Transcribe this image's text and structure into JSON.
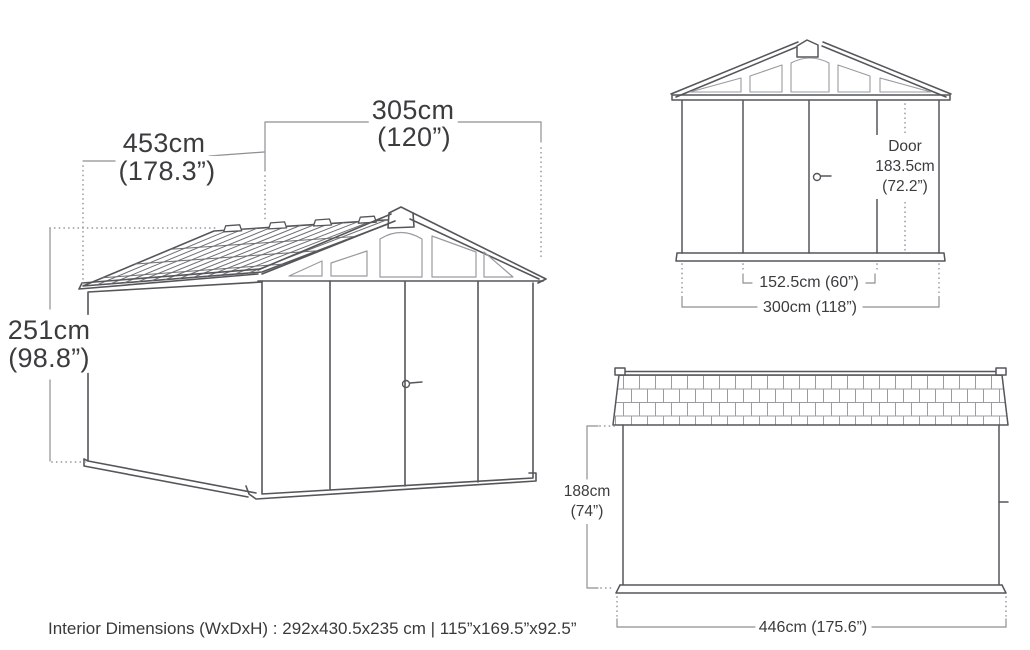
{
  "diagram_title": "Storage shed exterior dimensions diagram",
  "colors": {
    "background": "#ffffff",
    "line_art": "#55565a",
    "light_lines": "#9a9b9e",
    "dimension_lines": "#8e8f92",
    "text": "#3b3c3e"
  },
  "isometric_view": {
    "depth": {
      "cm": "453cm",
      "inches": "(178.3”)"
    },
    "width": {
      "cm": "305cm",
      "inches": "(120”)"
    },
    "height": {
      "cm": "251cm",
      "inches": "(98.8”)"
    }
  },
  "front_view": {
    "door": {
      "label": "Door",
      "height_cm": "183.5cm",
      "height_inches": "(72.2”)"
    },
    "door_width": "152.5cm (60”)",
    "exterior_width": "300cm (118”)"
  },
  "side_view": {
    "wall_height": {
      "cm": "188cm",
      "inches": "(74”)"
    },
    "depth": "446cm (175.6”)"
  },
  "footer": {
    "interior_dimensions": "Interior Dimensions (WxDxH) : 292x430.5x235 cm | 115”x169.5”x92.5”"
  }
}
